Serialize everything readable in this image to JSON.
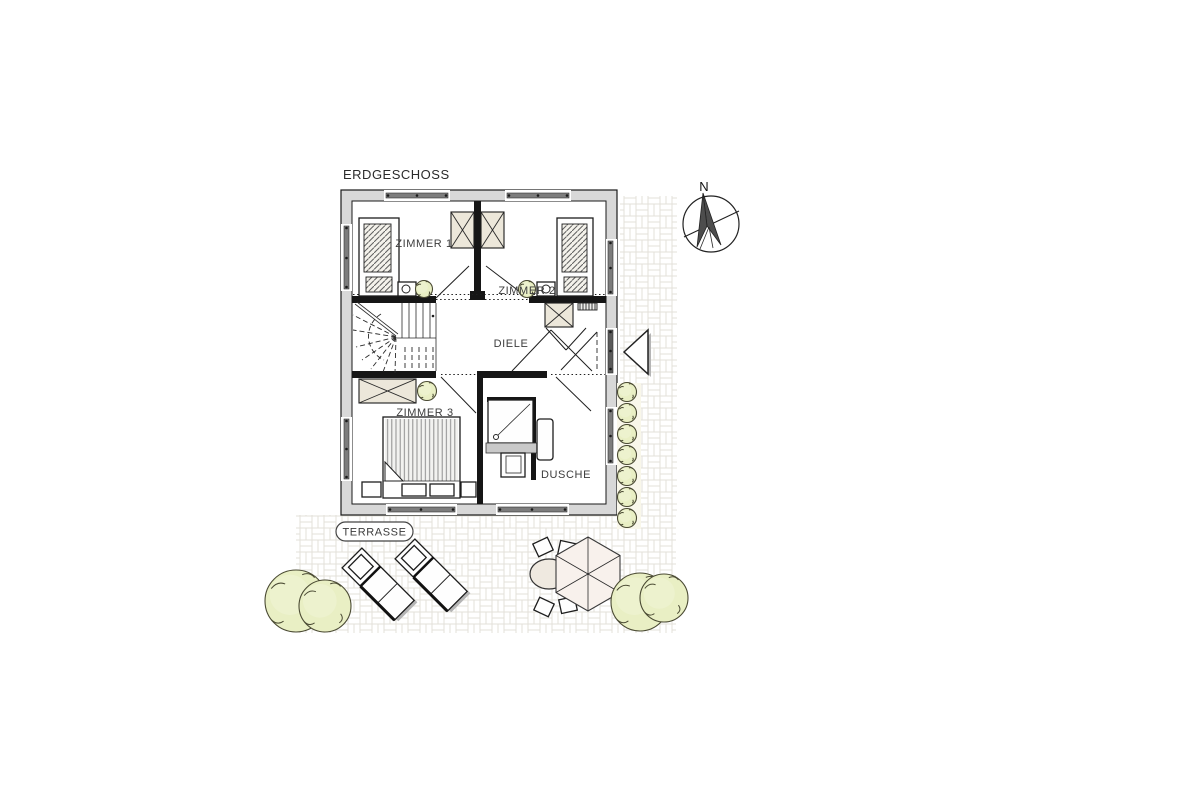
{
  "title": "ERDGESCHOSS",
  "compass": {
    "north": "N"
  },
  "rooms": {
    "zimmer1": "ZIMMER 1",
    "zimmer2": "ZIMMER 2",
    "zimmer3": "ZIMMER 3",
    "diele": "DIELE",
    "dusche": "DUSCHE"
  },
  "outdoor": {
    "terrasse": "TERRASSE"
  },
  "colors": {
    "wall_fill": "#d8d8d8",
    "wall_line": "#1a1a1a",
    "window_glass": "#7d7d7d",
    "furniture_beige": "#ece7da",
    "shrub_green": "#e9efc4",
    "shrub_outline": "#4a4a33",
    "paving_line": "#e3e1da",
    "label_text": "#3c3c3c",
    "parasol_fill": "#f8f1ec",
    "table_fill": "#efe9e0",
    "shadow_gray": "#b5b5b5"
  }
}
